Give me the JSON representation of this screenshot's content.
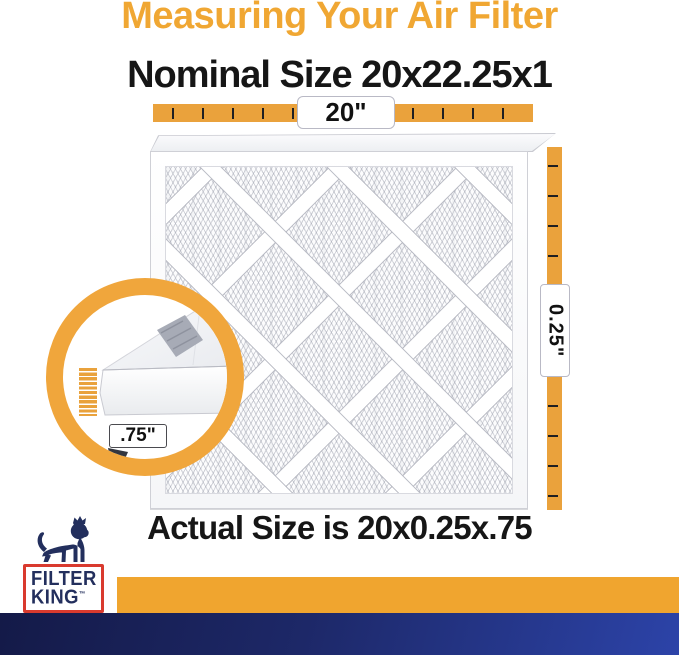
{
  "title": "Measuring Your Air Filter",
  "nominal_size": "Nominal Size 20x22.25x1",
  "actual_size": "Actual Size is 20x0.25x.75",
  "measurements": {
    "width": "20\"",
    "depth": "0.25\"",
    "height": ".75\""
  },
  "logo": {
    "line1": "FILTER",
    "line2": "KING",
    "trademark": "™",
    "icon": "lion-crown-icon"
  },
  "colors": {
    "title_orange": "#F0A733",
    "ruler_orange": "#EAA23C",
    "ring_orange": "#F0A63C",
    "bottom_bar_orange": "#F0A52F",
    "navy_text": "#232F5D",
    "logo_red": "#D93A2E",
    "bottom_bar_navy_start": "#141A48",
    "bottom_bar_navy_end": "#2C43A8",
    "heading_black": "#161616"
  }
}
